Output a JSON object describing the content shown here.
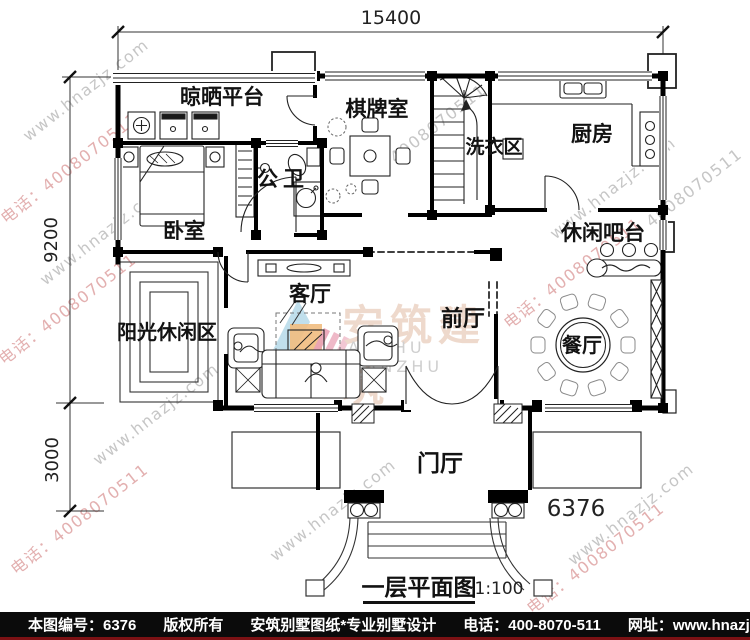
{
  "dims": {
    "top": "15400",
    "left_upper": "9200",
    "left_lower": "3000",
    "entry_width": "6376"
  },
  "rooms": {
    "drying_platform": "晾晒平台",
    "chess_room": "棋牌室",
    "laundry": "洗衣区",
    "kitchen": "厨房",
    "bathroom": "公卫",
    "bedroom": "卧室",
    "bar": "休闲吧台",
    "living_room": "客厅",
    "front_hall": "前厅",
    "sun_lounge": "阳光休闲区",
    "dining_room": "餐厅",
    "entry_hall": "门厅"
  },
  "title": {
    "name": "一层平面图",
    "scale": "1:100"
  },
  "watermark": {
    "brand": "安筑建筑",
    "brand_latin": "ANZHU JIANZHU",
    "colors": {
      "gray": "#c6c6c6",
      "pink": "#e3b0b0"
    },
    "lines": [
      {
        "text": "www.hnazjz.com",
        "color": "gray",
        "x": 25,
        "y": 128
      },
      {
        "text": "电话：4008070511",
        "color": "pink",
        "x": 2,
        "y": 207
      },
      {
        "text": "4008070511",
        "color": "gray",
        "x": 392,
        "y": 150
      },
      {
        "text": "www.hnazjz.com",
        "color": "gray",
        "x": 42,
        "y": 272
      },
      {
        "text": "电话：4008070511",
        "color": "pink",
        "x": 0,
        "y": 348
      },
      {
        "text": "www.hnazjz.com",
        "color": "gray",
        "x": 552,
        "y": 226
      },
      {
        "text": "电话：4008070511",
        "color": "pink",
        "x": 505,
        "y": 312
      },
      {
        "text": "www.hnazjz.com",
        "color": "gray",
        "x": 95,
        "y": 452
      },
      {
        "text": "电话：4008070511",
        "color": "pink",
        "x": 12,
        "y": 558
      },
      {
        "text": "www.hnazjz.com",
        "color": "gray",
        "x": 272,
        "y": 548
      },
      {
        "text": "电话：4008070511",
        "color": "pink",
        "x": 528,
        "y": 597
      },
      {
        "text": "www.hnazjz.com",
        "color": "gray",
        "x": 570,
        "y": 552
      },
      {
        "text": "4008070511",
        "color": "gray",
        "x": 648,
        "y": 214
      }
    ]
  },
  "footer": {
    "sheet_no": "本图编号：6376",
    "copyright": "版权所有",
    "brand_line": "安筑别墅图纸*专业别墅设计",
    "phone": "电话：400-8070-511",
    "site": "网址：www.hnazjz.com"
  }
}
